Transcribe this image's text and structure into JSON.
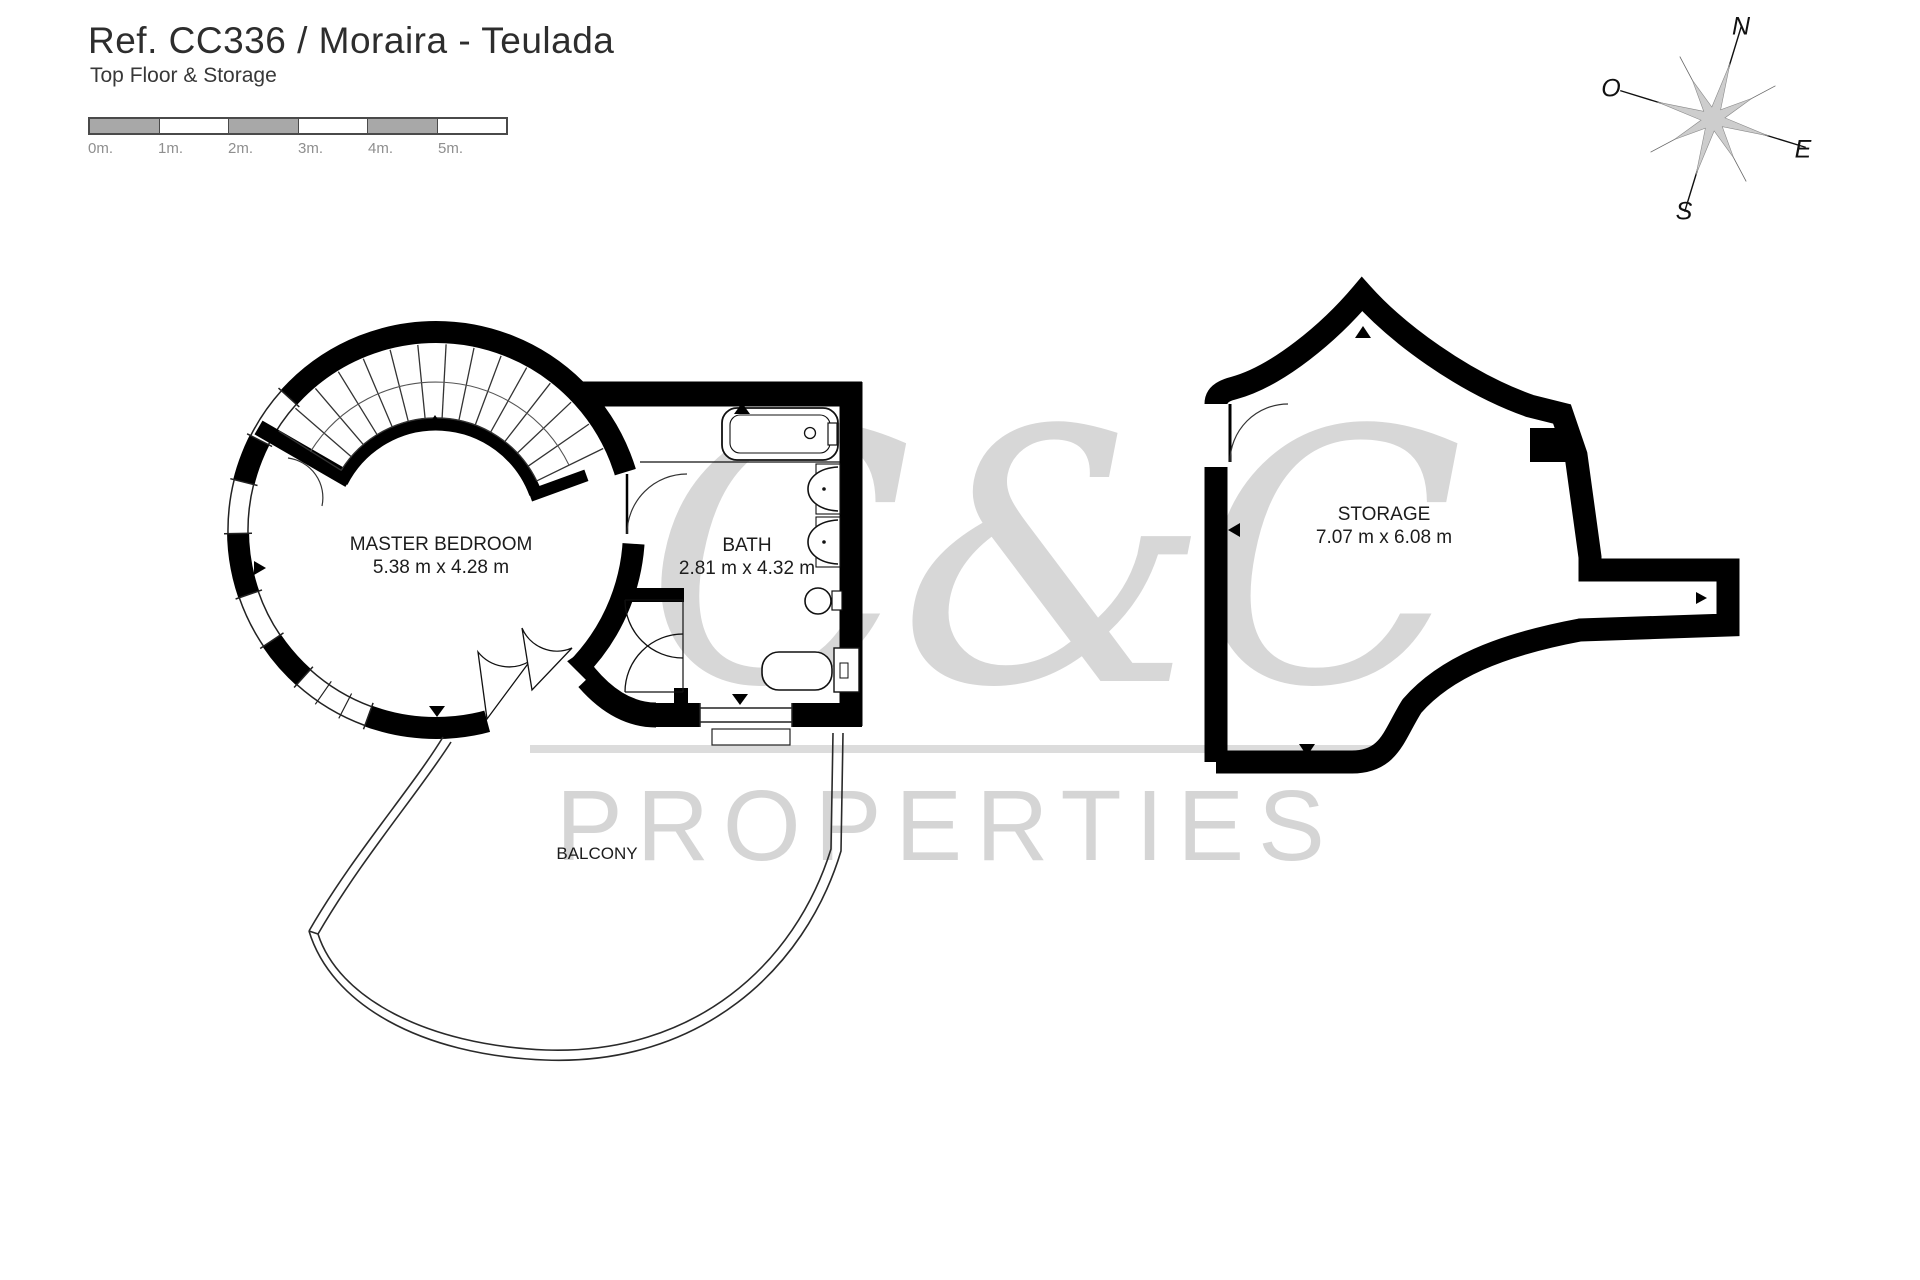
{
  "header": {
    "title": "Ref. CC336 / Moraira - Teulada",
    "subtitle": "Top Floor & Storage"
  },
  "scale_bar": {
    "unit_labels": [
      "0m.",
      "1m.",
      "2m.",
      "3m.",
      "4m.",
      "5m."
    ]
  },
  "compass": {
    "n": "N",
    "o": "O",
    "e": "E",
    "s": "S"
  },
  "rooms": {
    "master_bedroom": {
      "name": "MASTER BEDROOM",
      "dimensions": "5.38 m x 4.28 m"
    },
    "bath": {
      "name": "BATH",
      "dimensions": "2.81 m x 4.32 m"
    },
    "storage": {
      "name": "STORAGE",
      "dimensions": "7.07 m x 6.08 m"
    },
    "balcony": {
      "name": "BALCONY"
    }
  },
  "watermark": {
    "logo": "C&C",
    "text": "PROPERTIES"
  },
  "colors": {
    "wall": "#000000",
    "fixture_line": "#111111",
    "watermark_gray": "#d6d6d6",
    "scale_gray": "#a8a8a8"
  }
}
